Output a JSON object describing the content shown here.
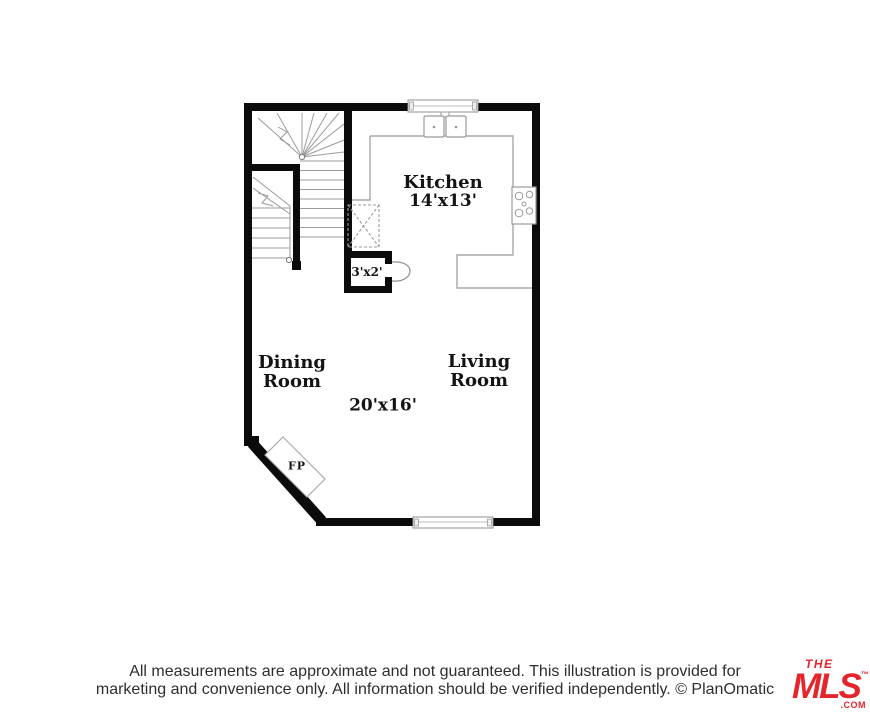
{
  "floor_plan": {
    "kitchen_label": "Kitchen",
    "kitchen_dims": "14'x13'",
    "dining_line1": "Dining",
    "dining_line2": "Room",
    "living_line1": "Living",
    "living_line2": "Room",
    "main_dims": "20'x16'",
    "closet_dims": "3'x2'",
    "fireplace_label": "FP"
  },
  "footer": {
    "disclaimer_line1": "All measurements are approximate and not guaranteed. This illustration is provided for",
    "disclaimer_line2": "marketing and convenience only. All information should be verified independently. © PlanOmatic"
  },
  "logo": {
    "the": "THE",
    "mls": "MLS",
    "trademark": "™",
    "com": ".COM"
  },
  "colors": {
    "wall": "#0b0b0b",
    "stair_line": "#9b9b9b",
    "fixture_line": "#999999",
    "logo_red": "#e4252c"
  }
}
